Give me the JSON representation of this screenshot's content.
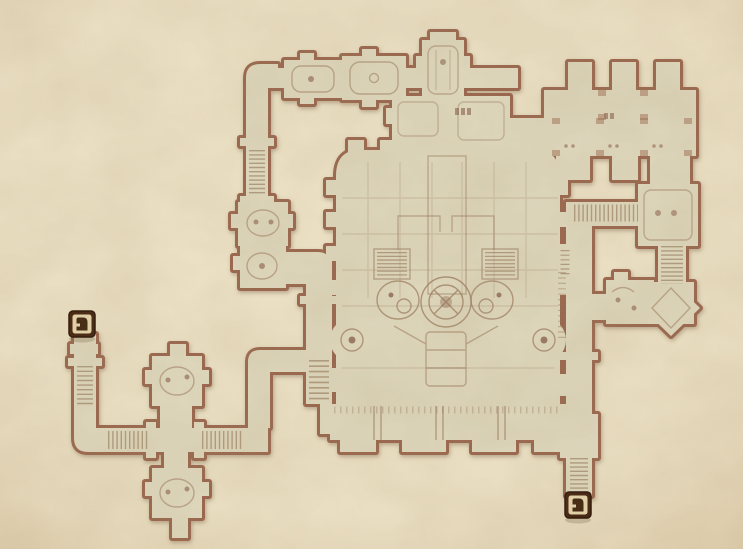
{
  "window": {
    "kind": "game-map-screen",
    "description": "Hand-drawn dungeon floor plan on aged parchment with two door markers"
  },
  "map": {
    "surface": "parchment",
    "colors": {
      "parchment": "#eadfc3",
      "floor": "#ddd6bb",
      "wall": "#9a6850",
      "wall_dark": "#7a4c38",
      "detail": "#97765a",
      "stair": "#8f7356",
      "marker_outer": "#42230f",
      "marker_border": "#2a1507",
      "marker_frame": "#e5d4ac",
      "marker_glyph": "#40250f",
      "marker_shadow": "#7a6948"
    },
    "markers": [
      {
        "name": "door-marker-west",
        "kind": "door",
        "x": 82,
        "y": 324
      },
      {
        "name": "door-marker-southeast",
        "kind": "door",
        "x": 578,
        "y": 505
      }
    ],
    "regions": [
      {
        "name": "west-entry-corridor"
      },
      {
        "name": "southwest-cross-junction"
      },
      {
        "name": "west-connector"
      },
      {
        "name": "north-corridor"
      },
      {
        "name": "northwest-junction-rooms"
      },
      {
        "name": "north-tower"
      },
      {
        "name": "antechambers"
      },
      {
        "name": "north-pillared-halls"
      },
      {
        "name": "northeast-room"
      },
      {
        "name": "east-stair-corridor"
      },
      {
        "name": "east-stairwell"
      },
      {
        "name": "diamond-chamber"
      },
      {
        "name": "east-exit-corridor"
      },
      {
        "name": "great-hall"
      }
    ]
  }
}
